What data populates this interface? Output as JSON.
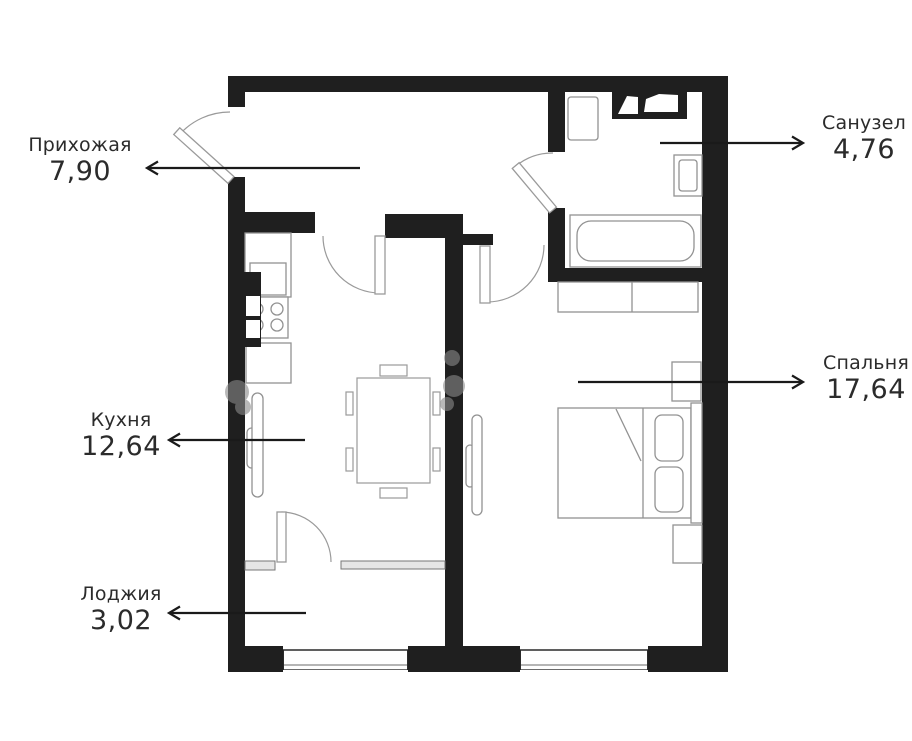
{
  "page": {
    "background": "#ffffff"
  },
  "colors": {
    "wall": "#1f1f1f",
    "furniture_outline": "#929292",
    "text": "#2b2b2b",
    "arrow": "#1a1a1a"
  },
  "rooms": [
    {
      "id": "hallway",
      "name": "Прихожая",
      "area": "7,90",
      "arrow_direction": "left"
    },
    {
      "id": "bathroom",
      "name": "Санузел",
      "area": "4,76",
      "arrow_direction": "right"
    },
    {
      "id": "bedroom",
      "name": "Спальня",
      "area": "17,64",
      "arrow_direction": "right"
    },
    {
      "id": "kitchen",
      "name": "Кухня",
      "area": "12,64",
      "arrow_direction": "left"
    },
    {
      "id": "loggia",
      "name": "Лоджия",
      "area": "3,02",
      "arrow_direction": "left"
    }
  ],
  "fixtures": [
    "entrance-door",
    "bathroom-door",
    "bedroom-door",
    "kitchen-door",
    "loggia-door",
    "kitchen-counter",
    "kitchen-sink",
    "stove",
    "ventilation-shaft",
    "dining-table",
    "chairs",
    "radiator",
    "bathtub",
    "washbasin-counter",
    "toilet",
    "washing-machine",
    "wardrobe",
    "bed",
    "pillows",
    "nightstand",
    "window"
  ]
}
